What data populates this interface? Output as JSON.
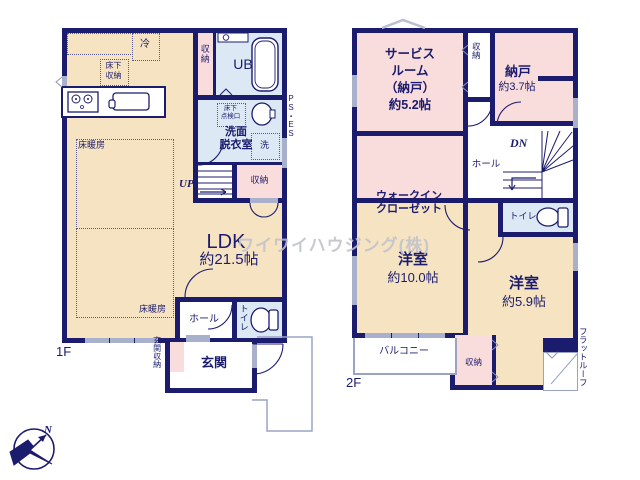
{
  "watermark": "ワイワイハウジング(株)",
  "compass": {
    "north": "N"
  },
  "colors": {
    "wall_navy": "#1c1c6e",
    "floor_cream": "#f6e3c2",
    "floor_pink": "#f9dcdc",
    "floor_blue": "#dce9f5",
    "window_gray": "#a9b0cc",
    "watermark_gray": "#bfc1cb"
  },
  "floor1": {
    "label": "1F",
    "ldk_name": "LDK",
    "ldk_size": "約21.5帖",
    "floor_heating_a": "床暖房",
    "floor_heating_b": "床暖房",
    "fridge": "冷",
    "underfloor_storage": "床下\n収納",
    "storage_a": "収納",
    "unit_bath": "UB",
    "inspection_hatch": "床下\n点検口",
    "washroom": "洗面\n脱衣室",
    "washer": "洗",
    "pipe_space": "PS・ES",
    "up": "UP",
    "storage_b": "収納",
    "hall": "ホール",
    "toilet": "トイレ",
    "entrance_storage": "玄関収納",
    "entrance": "玄関"
  },
  "floor2": {
    "label": "2F",
    "service_room": "サービス\nルーム\n（納戸）\n約5.2帖",
    "storage_top": "収納",
    "nando_name": "納戸",
    "nando_size": "約3.7帖",
    "wic": "ウォークイン\nクローゼット",
    "hall": "ホール",
    "dn": "DN",
    "toilet": "トイレ",
    "bedroom1_name": "洋室",
    "bedroom1_size": "約10.0帖",
    "bedroom2_name": "洋室",
    "bedroom2_size": "約5.9帖",
    "balcony": "バルコニー",
    "storage_bottom": "収納",
    "flat_roof": "フラットルーフ"
  }
}
